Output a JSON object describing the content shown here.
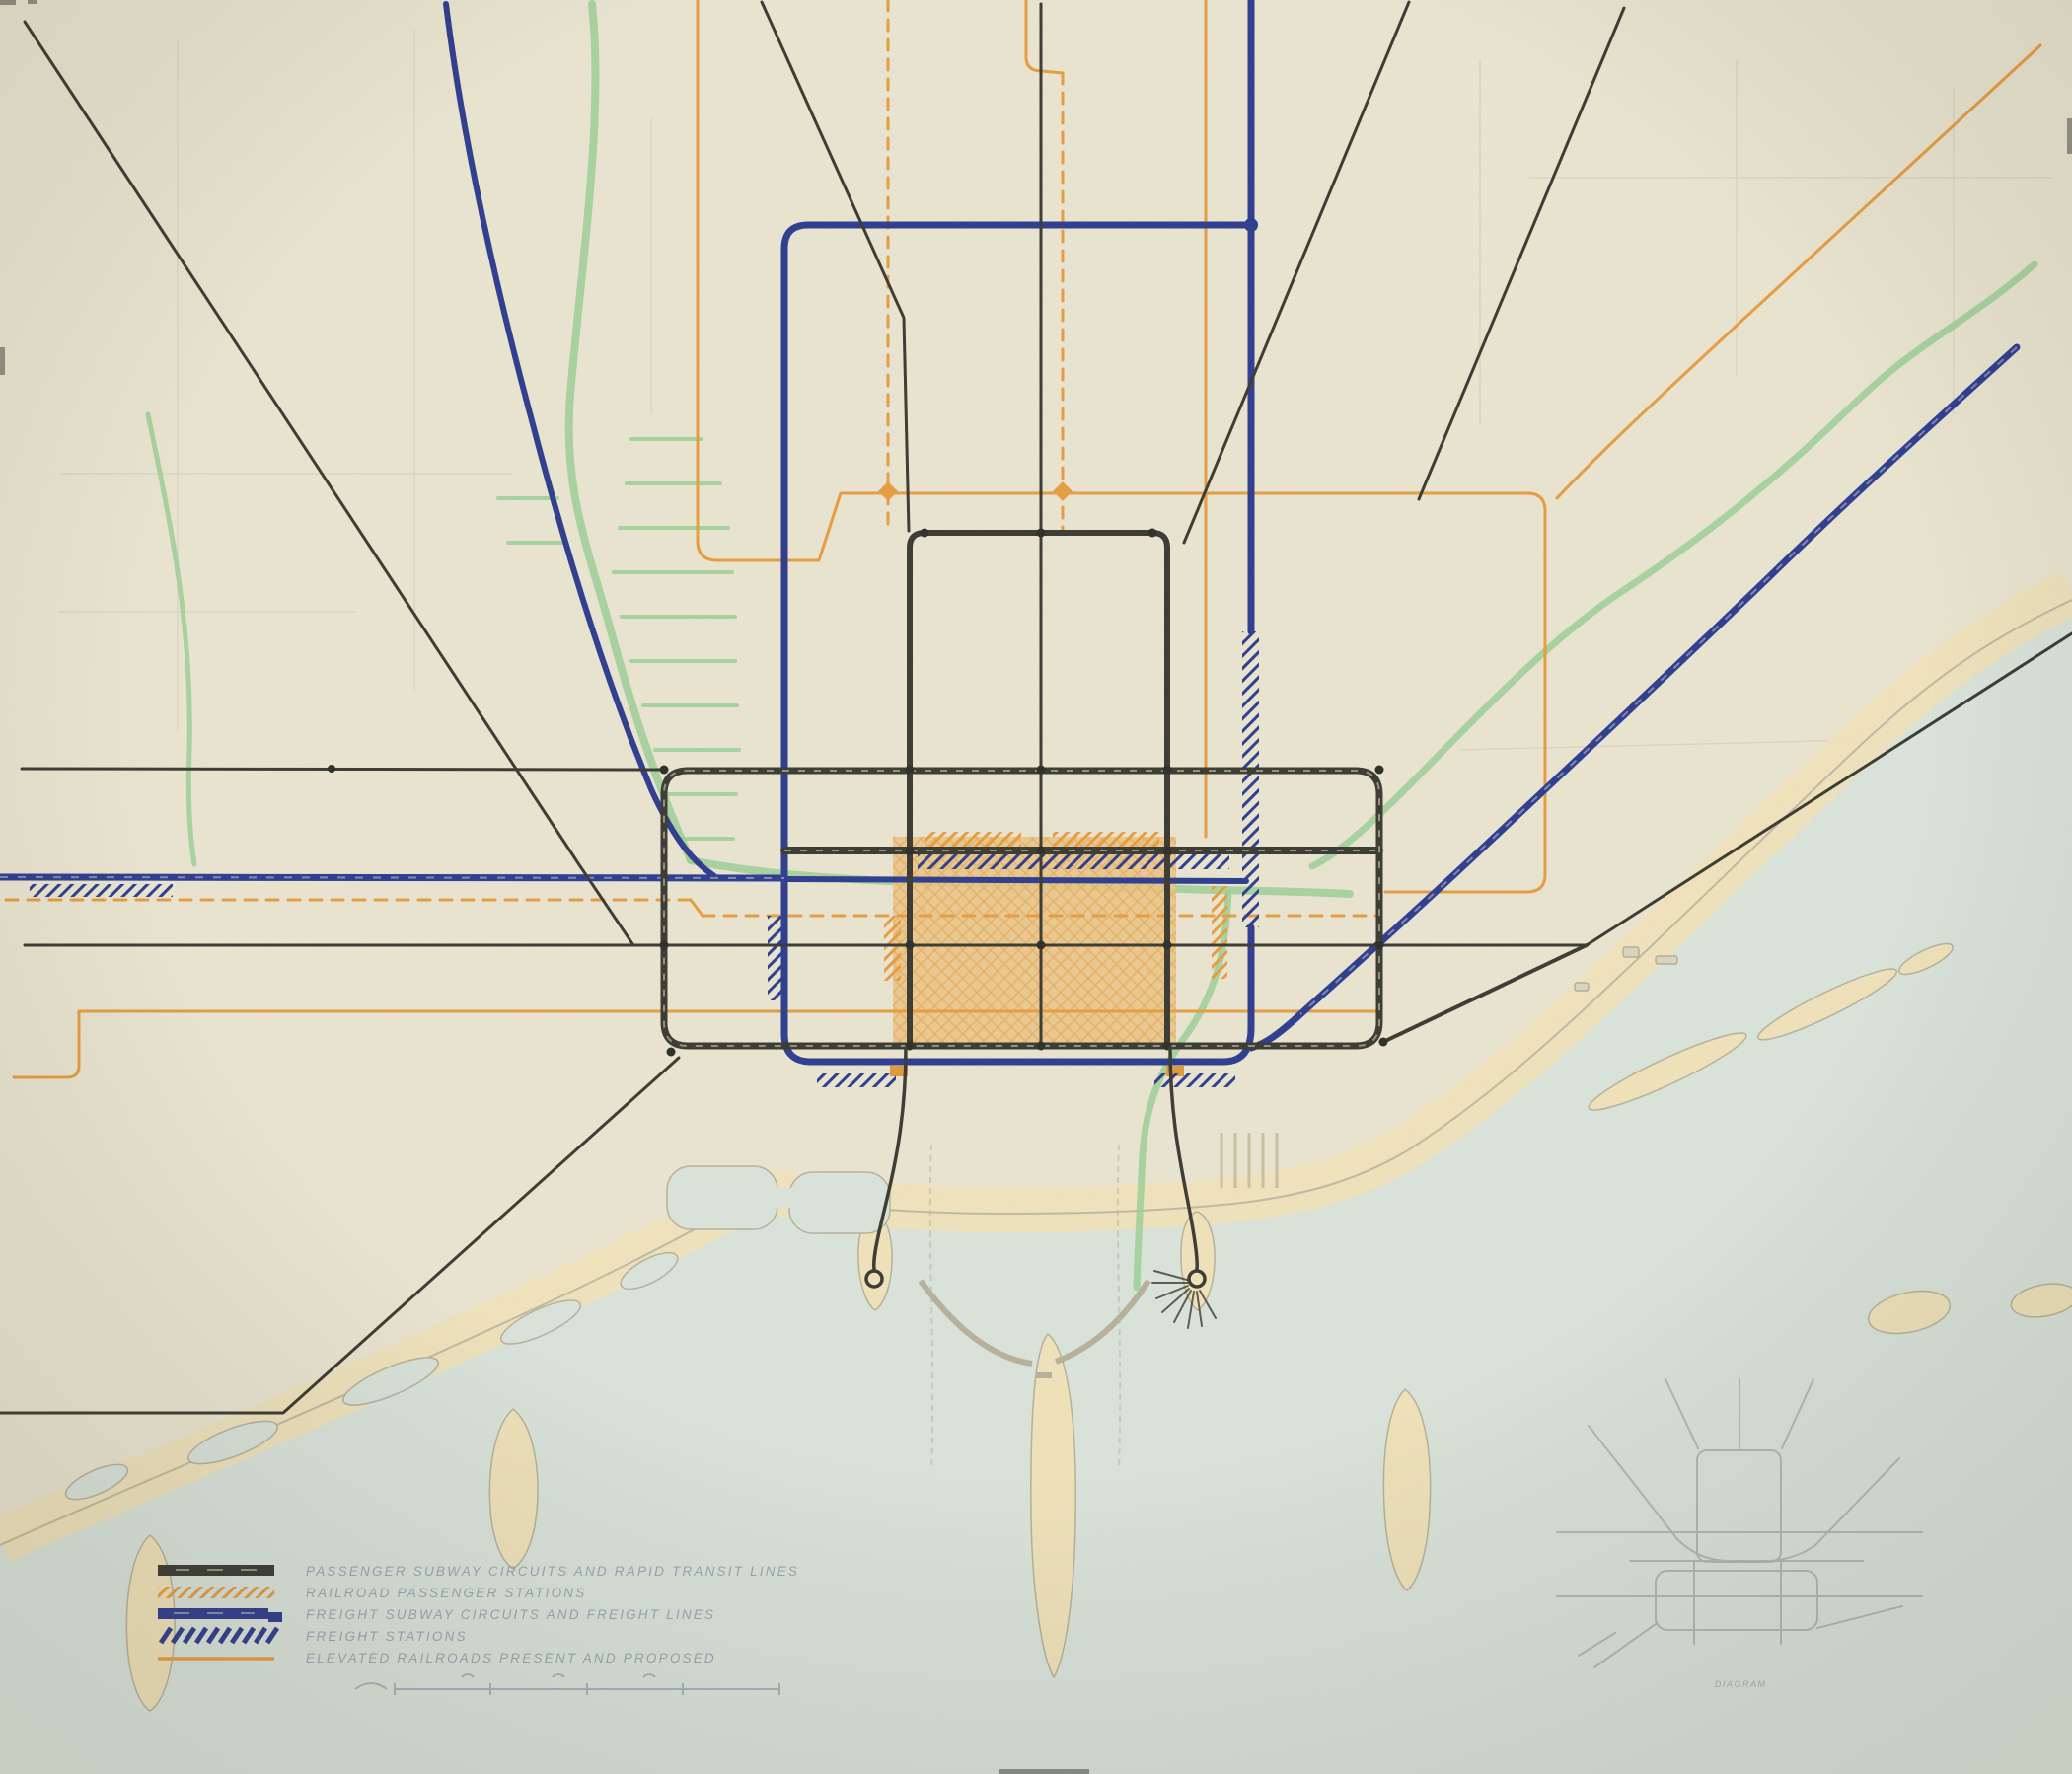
{
  "legend": {
    "items": [
      {
        "label": "PASSENGER SUBWAY CIRCUITS AND RAPID TRANSIT LINES",
        "swatch": "black-bar"
      },
      {
        "label": "RAILROAD PASSENGER STATIONS",
        "swatch": "orange-hatch"
      },
      {
        "label": "FREIGHT SUBWAY CIRCUITS AND FREIGHT LINES",
        "swatch": "blue-bar"
      },
      {
        "label": "FREIGHT STATIONS",
        "swatch": "blue-hatch"
      },
      {
        "label": "ELEVATED RAILROADS PRESENT AND PROPOSED",
        "swatch": "orange-line"
      }
    ]
  },
  "inset": {
    "caption": "DIAGRAM"
  },
  "colors": {
    "paper": "#e9e4cf",
    "water": "#d9e3da",
    "shore_fill": "#efe2ba",
    "shore_line": "#b5b19b",
    "river": "#9ccf96",
    "ink": "#3b3b33",
    "freight": "#2e3d8f",
    "elevated": "#e59d41",
    "station": "#de9a3c",
    "district": "#e2a855",
    "faint": "#9fae9e",
    "legend_text": "#91a0af",
    "pencil": "#b9b4a0"
  }
}
